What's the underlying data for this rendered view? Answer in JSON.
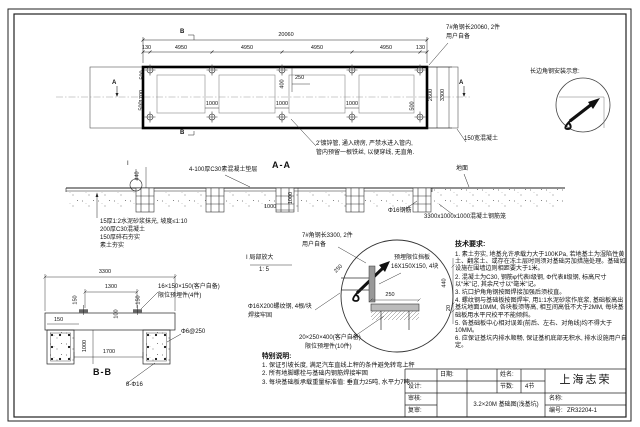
{
  "plan": {
    "dim_total": "20060",
    "dims_top": [
      "130",
      "4950",
      "4950",
      "4950",
      "4950",
      "130"
    ],
    "dim_500_top": "500",
    "dim_1700": "1700",
    "dim_400": "400",
    "dim_250": "250",
    "dims_bottom": [
      "500",
      "1000",
      "1000",
      "1000",
      "500"
    ],
    "dim_right_inner": "2600",
    "dim_right_outer": "3300",
    "mark_b": "B",
    "mark_a": "A",
    "note_angle_line1": "7#角钢长20060, 2件",
    "note_angle_line2": "用户自备",
    "note_edge": "150宽混凝土",
    "note_pipe_line1": "2'镀锌管, 通入磅房, 严禁水进入管内,",
    "note_pipe_line2": "管内预留一根铁丝, 以便穿线, 无直角."
  },
  "install": {
    "title": "长边角钢安装示意:"
  },
  "aa": {
    "label": "A-A",
    "flag": "I",
    "cushion": "4-100厚C30素混凝土垫层",
    "ground": "地面",
    "rebar": "Φ16钢筋",
    "cage": "3300x1000x1000混凝土钢筋笼",
    "dim_440": "440",
    "dim_1000v": "1000",
    "dim_1000h": "1000",
    "layers": [
      "15厚1:2水泥砂浆抹光, 坡度≤1:10",
      "200厚C30混凝土",
      "150厚碎石夯实",
      "素土夯实"
    ]
  },
  "detail": {
    "title": "I 局部放大",
    "scale": "1: 5",
    "note_angle_line1": "7#角钢长3300, 2件",
    "note_angle_line2": "用户自备",
    "note_plate_line1": "预埋限位挡板",
    "note_plate_line2": "16X150X150, 4块",
    "note_rebar_line1": "Φ16X200螺纹钢, 4根/块",
    "note_rebar_line2": "焊接牢固",
    "note_embed_line1": "20×250×400(客户自备)",
    "note_embed_line2": "限位预埋件(10件)",
    "dim_250_plate": "250",
    "dim_250_arrow": "250",
    "dim_440": "440",
    "dim_20": "20"
  },
  "bb": {
    "label": "B-B",
    "dim_3300": "3300",
    "dim_1300": "1300",
    "dim_150_left": "150",
    "dim_150_right": "150",
    "dim_150_edge": "150",
    "dim_100": "100",
    "dim_1000": "1000",
    "dim_1700": "1700",
    "note_embed_line1": "16×150×150(客户自备)",
    "note_embed_line2": "限位预埋件(4件)",
    "stirrup": "Φ6@250",
    "rebar": "8-Φ16"
  },
  "tech": {
    "title": "技术要求:",
    "items": [
      "1. 素土夯实, 地基允许承载力大于100KPa, 若地基土为湿陷性黄土、翻浆土、或存在冻土层时则须对基础另加措施处理。基础如设施在围墙边则相距要大于1米。",
      "2. 混凝土为C30, 钢筋φ代表Ⅰ级钢, Φ代表Ⅱ级钢, 标高尺寸以“米”记, 其余尺寸以“毫米”记。",
      "3. 坑口护角角钢按图焊接加强后须校直。",
      "4. 螺纹钢与基础板按图焊牢, 用1:1水泥砂浆作底浆, 基础板高出基坑地面10MM, 各块板须等高, 相互间高低不大于2MM, 每块基础板用水平尺校平不能倾斜。",
      "5. 各基础板中心相对误差(前后、左右、对角线)均不得大于10MM。",
      "6. 应保证基坑内排水顺畅, 保证基机底部无积水, 排水设施用户自定。"
    ]
  },
  "special": {
    "title": "特别说明:",
    "items": [
      "1. 保证引坡长度, 满足汽车直线上秤的条件避免转弯上秤",
      "2. 所有地脚螺栓与基础内钢筋焊接牢固",
      "3. 每块基础板承载重量标准值: 垂直力25吨, 水平力7吨"
    ]
  },
  "title_block": {
    "date_label": "日期:",
    "design_label": "设计:",
    "check_label": "审核:",
    "recheck_label": "复审:",
    "name_label": "姓名:",
    "sections_label": "节数:",
    "sections_value": "4节",
    "drawing_name": "3.2×20M 基础图(浅基坑)",
    "company": "上海志荣",
    "title_label": "名称:",
    "no_label": "编号:",
    "no_value": "ZR32204-1"
  }
}
